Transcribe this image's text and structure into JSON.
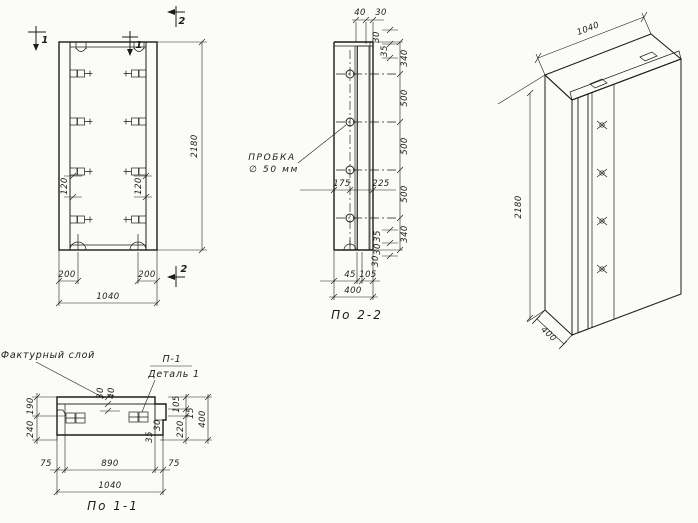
{
  "drawing": {
    "elevation": {
      "mark_1_left": "1",
      "mark_1_right": "1",
      "mark_2_top": "2",
      "mark_2_bottom": "2",
      "dim_height": "2180",
      "dim_loop_left": "120",
      "dim_loop_right": "120",
      "dim_hook_left": "200",
      "dim_hook_right": "200",
      "dim_width": "1040"
    },
    "section_2_2": {
      "title": "По 2-2",
      "plug_label_line1": "ПРОБКА",
      "plug_label_line2": "∅ 50 мм",
      "dim_top_40": "40",
      "dim_top_30": "30",
      "dim_edge_top_30": "30",
      "dim_edge_top_35": "35",
      "chain": {
        "c1": "340",
        "c2": "500",
        "c3": "500",
        "c4": "500",
        "c5": "340"
      },
      "dim_mid_left": "175",
      "dim_mid_right": "225",
      "dim_edge_bot_35": "35",
      "dim_edge_bot_30": "30",
      "dim_bot_45": "45",
      "dim_bot_105": "105",
      "dim_bot_30": "30",
      "dim_depth": "400"
    },
    "detail_1_1": {
      "title": "По 1-1",
      "label_facing": "Фактурный слой",
      "label_p1": "П-1",
      "label_detail": "Деталь 1",
      "dim_left_190": "190",
      "dim_left_240": "240",
      "dim_mid_30": "30",
      "dim_mid_40": "40",
      "dim_right_105": "105",
      "dim_right_15": "15",
      "dim_right_220": "220",
      "dim_right_400": "400",
      "dim_elem_30": "30",
      "dim_elem_35": "35",
      "dim_bot_75l": "75",
      "dim_bot_890": "890",
      "dim_bot_75r": "75",
      "dim_bot_1040": "1040"
    },
    "axonometric": {
      "dim_width": "1040",
      "dim_height": "2180",
      "dim_depth": "400"
    },
    "colors": {
      "ink": "#1c1c1c",
      "paper": "#fbfbf9"
    }
  }
}
